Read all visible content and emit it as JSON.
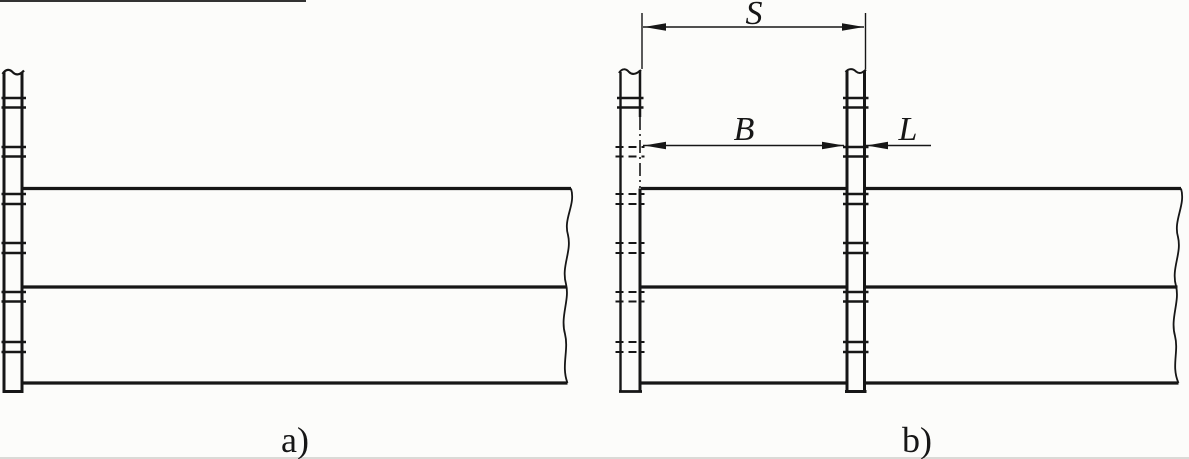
{
  "colors": {
    "background": "#fcfcfa",
    "line": "#161616"
  },
  "views": {
    "a": {
      "label": "a)"
    },
    "b": {
      "label": "b)",
      "dimensions": {
        "s": "S",
        "b": "B",
        "l": "L"
      }
    }
  }
}
